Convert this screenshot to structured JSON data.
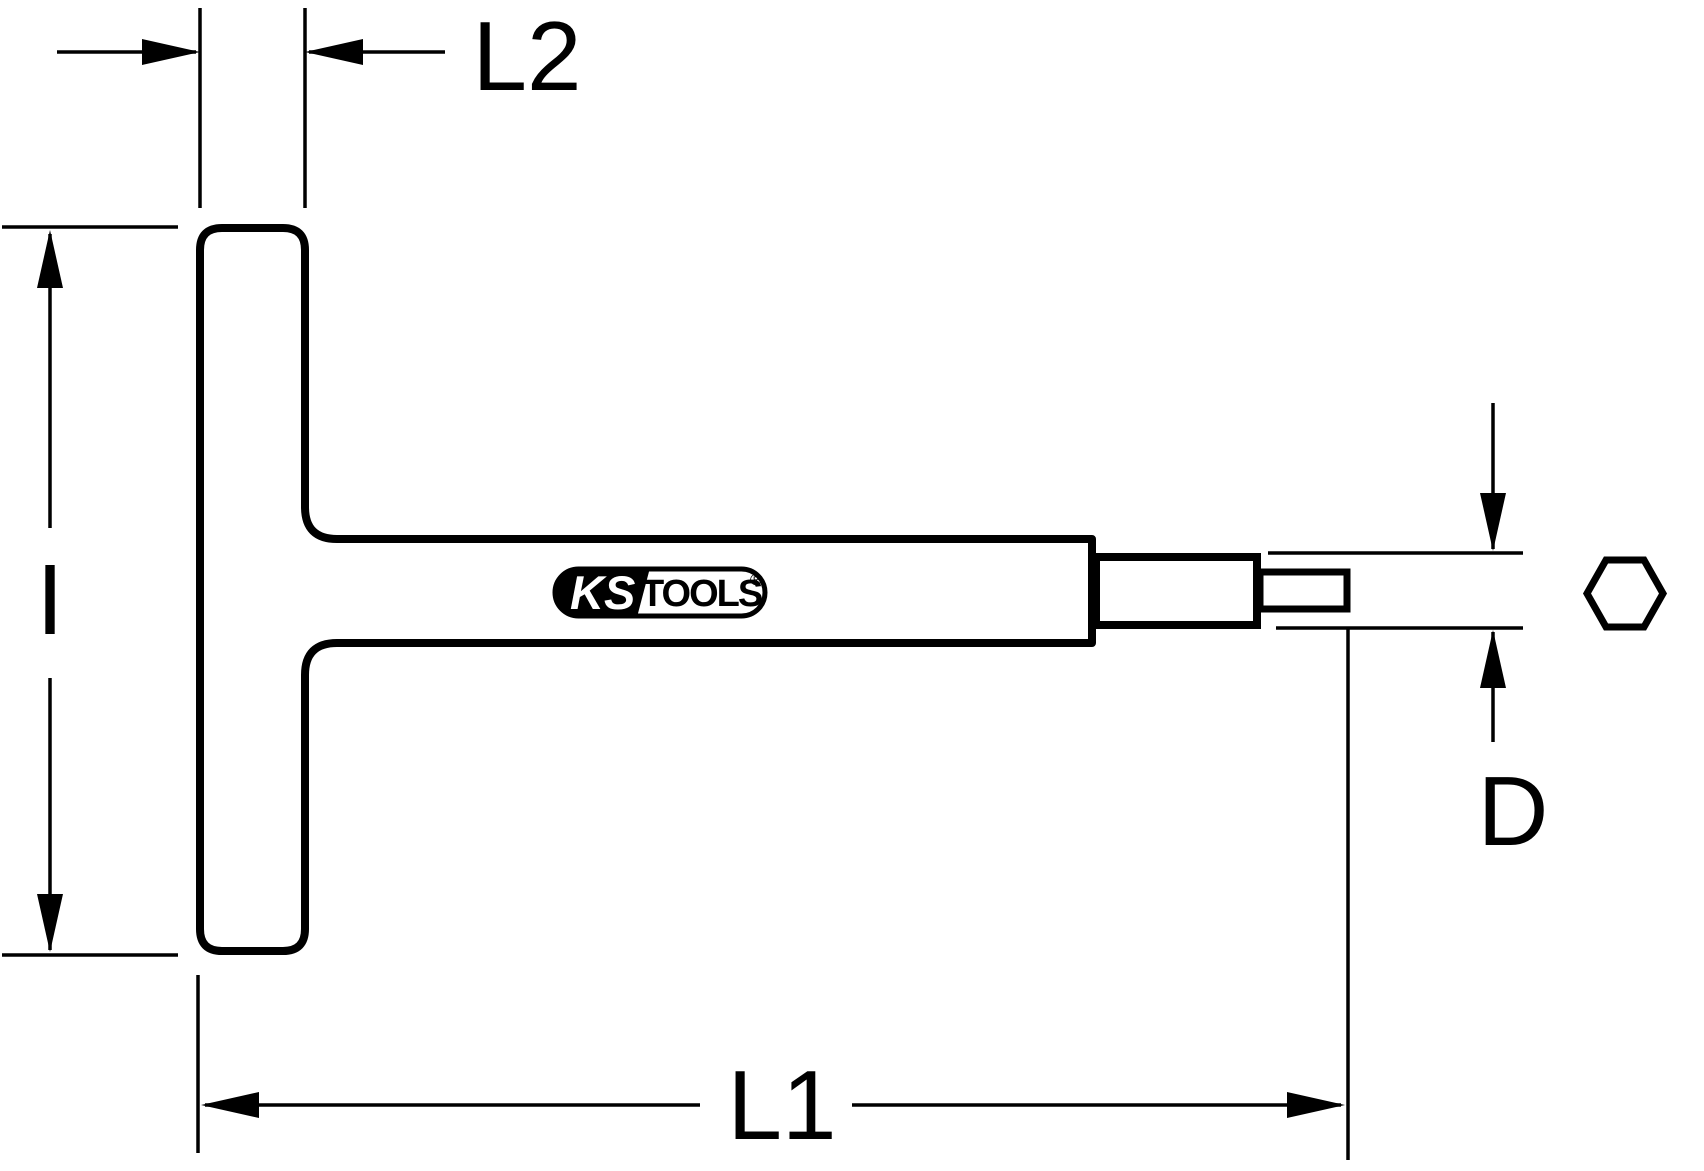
{
  "diagram": {
    "background_color": "#ffffff",
    "line_color": "#000000",
    "labels": {
      "handle_width": "L2",
      "handle_height": "I",
      "overall_length": "L1",
      "tip_diameter": "D"
    },
    "logo": {
      "ks": "KS",
      "tools": "TOOLS",
      "registered": "®"
    },
    "symbols": {
      "hex_cross_section": "hexagon"
    }
  }
}
